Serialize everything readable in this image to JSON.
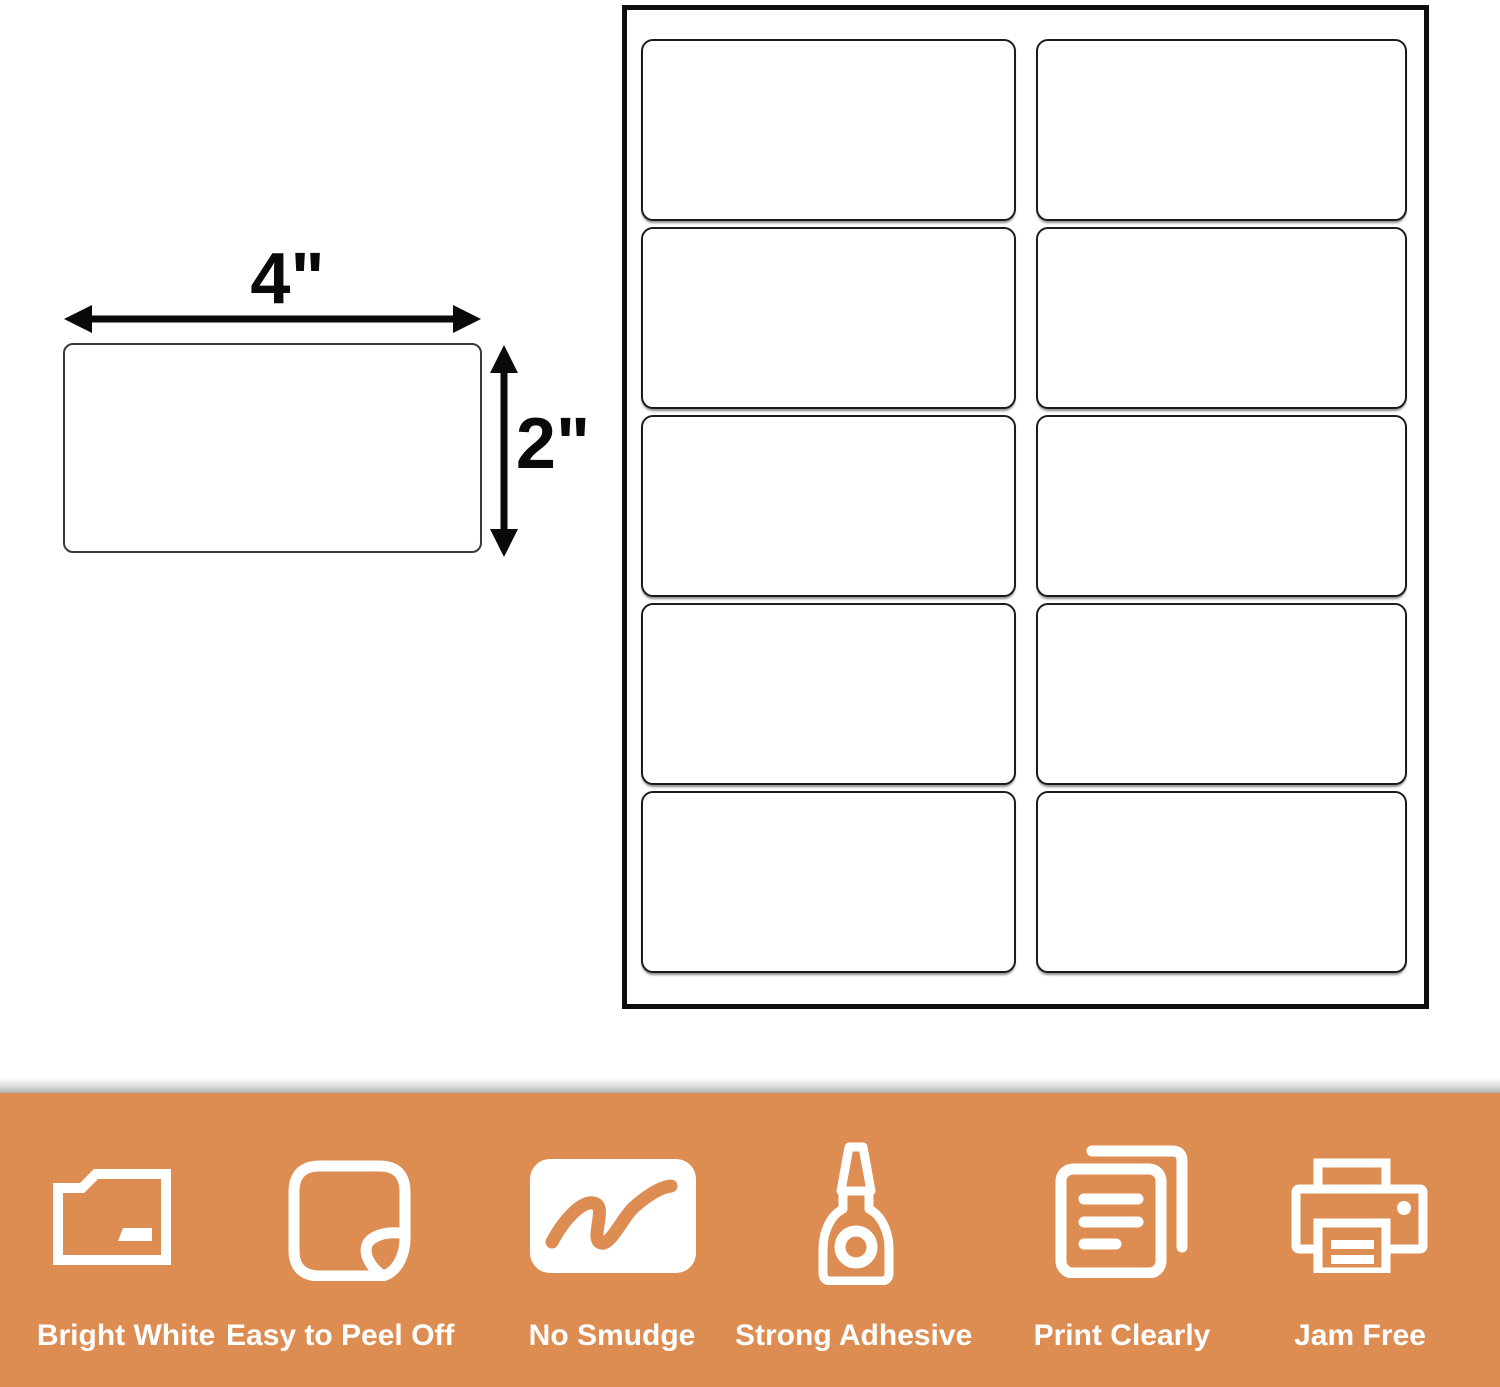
{
  "page": {
    "background_color": "#ffffff"
  },
  "diagram": {
    "width_label": "4\"",
    "height_label": "2\""
  },
  "sheet": {
    "columns": 2,
    "rows": 5,
    "label_count": 10
  },
  "banner": {
    "background_color": "#DD8C52",
    "text_color": "#ffffff",
    "features": [
      {
        "label": "Bright White",
        "icon": "folder-icon"
      },
      {
        "label": "Easy to Peel Off",
        "icon": "sticker-peel-icon"
      },
      {
        "label": "No Smudge",
        "icon": "marker-scribble-icon"
      },
      {
        "label": "Strong Adhesive",
        "icon": "glue-bottle-icon"
      },
      {
        "label": "Print Clearly",
        "icon": "documents-icon"
      },
      {
        "label": "Jam Free",
        "icon": "printer-icon"
      }
    ]
  }
}
